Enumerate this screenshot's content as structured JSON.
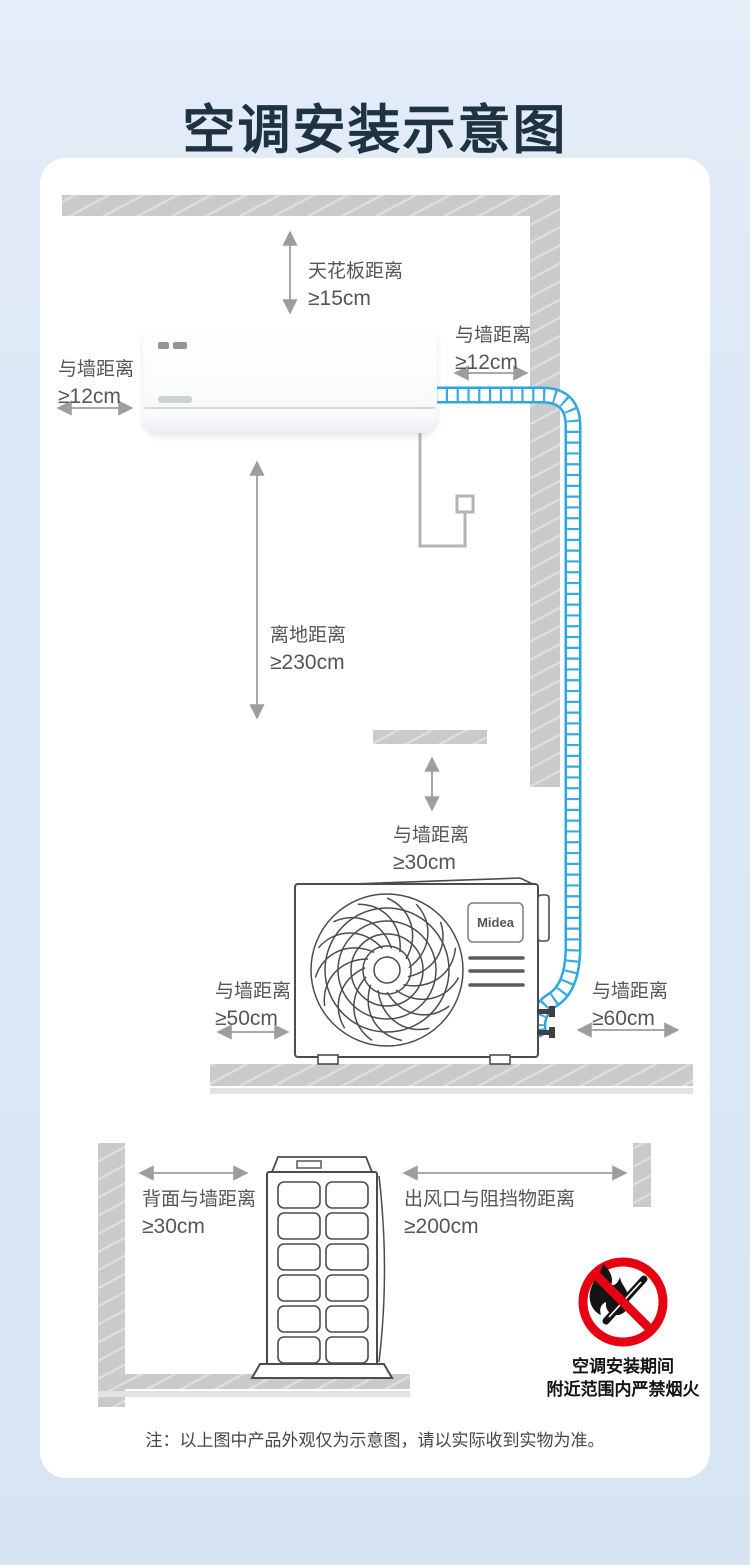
{
  "page": {
    "title": "空调安装示意图",
    "note": "注：以上图中产品外观仅为示意图，请以实际收到实物为准。"
  },
  "brand": {
    "outdoor_logo": "Midea"
  },
  "labels": {
    "ceiling": {
      "line1": "天花板距离",
      "line2": "≥15cm"
    },
    "wall_right": {
      "line1": "与墙距离",
      "line2": "≥12cm"
    },
    "wall_left": {
      "line1": "与墙距离",
      "line2": "≥12cm"
    },
    "floor_clearance": {
      "line1": "离地距离",
      "line2": "≥230cm"
    },
    "above_outdoor": {
      "line1": "与墙距离",
      "line2": "≥30cm"
    },
    "outdoor_left": {
      "line1": "与墙距离",
      "line2": "≥50cm"
    },
    "outdoor_right": {
      "line1": "与墙距离",
      "line2": "≥60cm"
    },
    "back_to_wall": {
      "line1": "背面与墙距离",
      "line2": "≥30cm"
    },
    "outlet_clearance": {
      "line1": "出风口与阻挡物距离",
      "line2": "≥200cm"
    }
  },
  "fire_warning": {
    "line1": "空调安装期间",
    "line2": "附近范围内严禁烟火"
  },
  "colors": {
    "background": "#dde9f6",
    "title": "#1f3242",
    "card": "#ffffff",
    "wall_gray": "#c9cacb",
    "label_text": "#55565a",
    "arrow_gray": "#9b9da0",
    "pipe_blue": "#2ea7e0",
    "warning_red": "#e60012"
  }
}
